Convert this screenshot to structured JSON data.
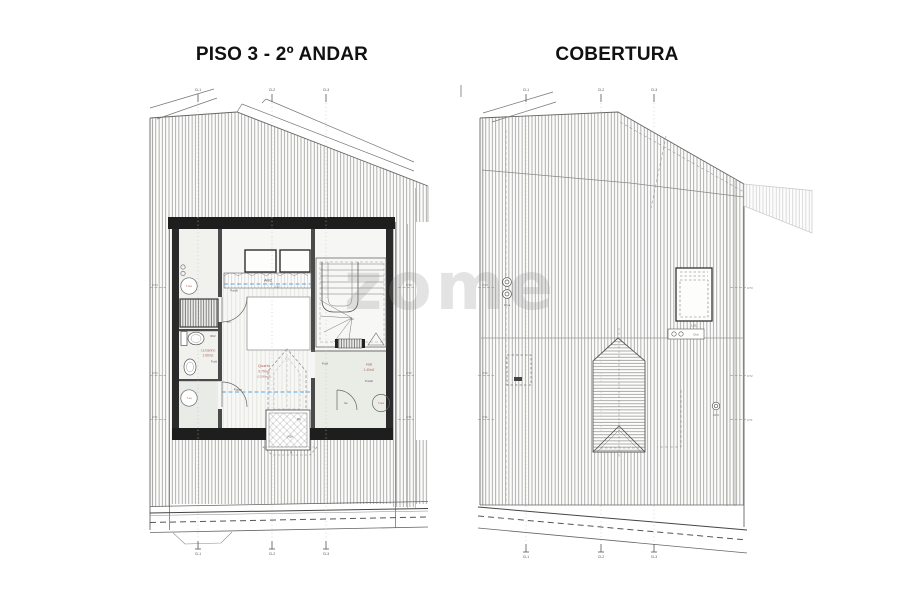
{
  "page": {
    "title_left": "PISO 3 - 2º ANDAR",
    "title_right": "COBERTURA",
    "watermark": "zome"
  },
  "grid": {
    "g1": "CL1",
    "g2": "CL2",
    "g3": "CL3"
  },
  "sections": {
    "ct1": "CT1",
    "ct2": "CT2",
    "ct3": "CT3"
  },
  "floor_plan": {
    "rooms": {
      "quarto": {
        "name": "Quarto",
        "area": "9.79m2",
        "area_total": "(13.80m2)"
      },
      "banho": {
        "name": "I.s.banho",
        "area": "2.66m2"
      },
      "hall": {
        "name": "Hall",
        "area": "1.40m2"
      }
    },
    "fixtures": {
      "arm": "Arm2",
      "height_line": "1.80",
      "t_ass": "T.ass",
      "t_aq": "T.aq"
    },
    "tags": {
      "pad": "P.a/d",
      "pad2": "P.a/d2",
      "pad6": "P.a/d6",
      "pappe": "P.appe",
      "ph": "Ph",
      "ge": "Ge",
      "rb2": "Rb2",
      "dg": "Dg",
      "jv": "JV1b",
      "j4": "J4",
      "lh": "LH"
    }
  },
  "roof_plan": {
    "skylight": "LS1",
    "vents": {
      "cha": "Ch.a",
      "chb": "Ch.b",
      "ch4": "Ch4"
    }
  }
}
